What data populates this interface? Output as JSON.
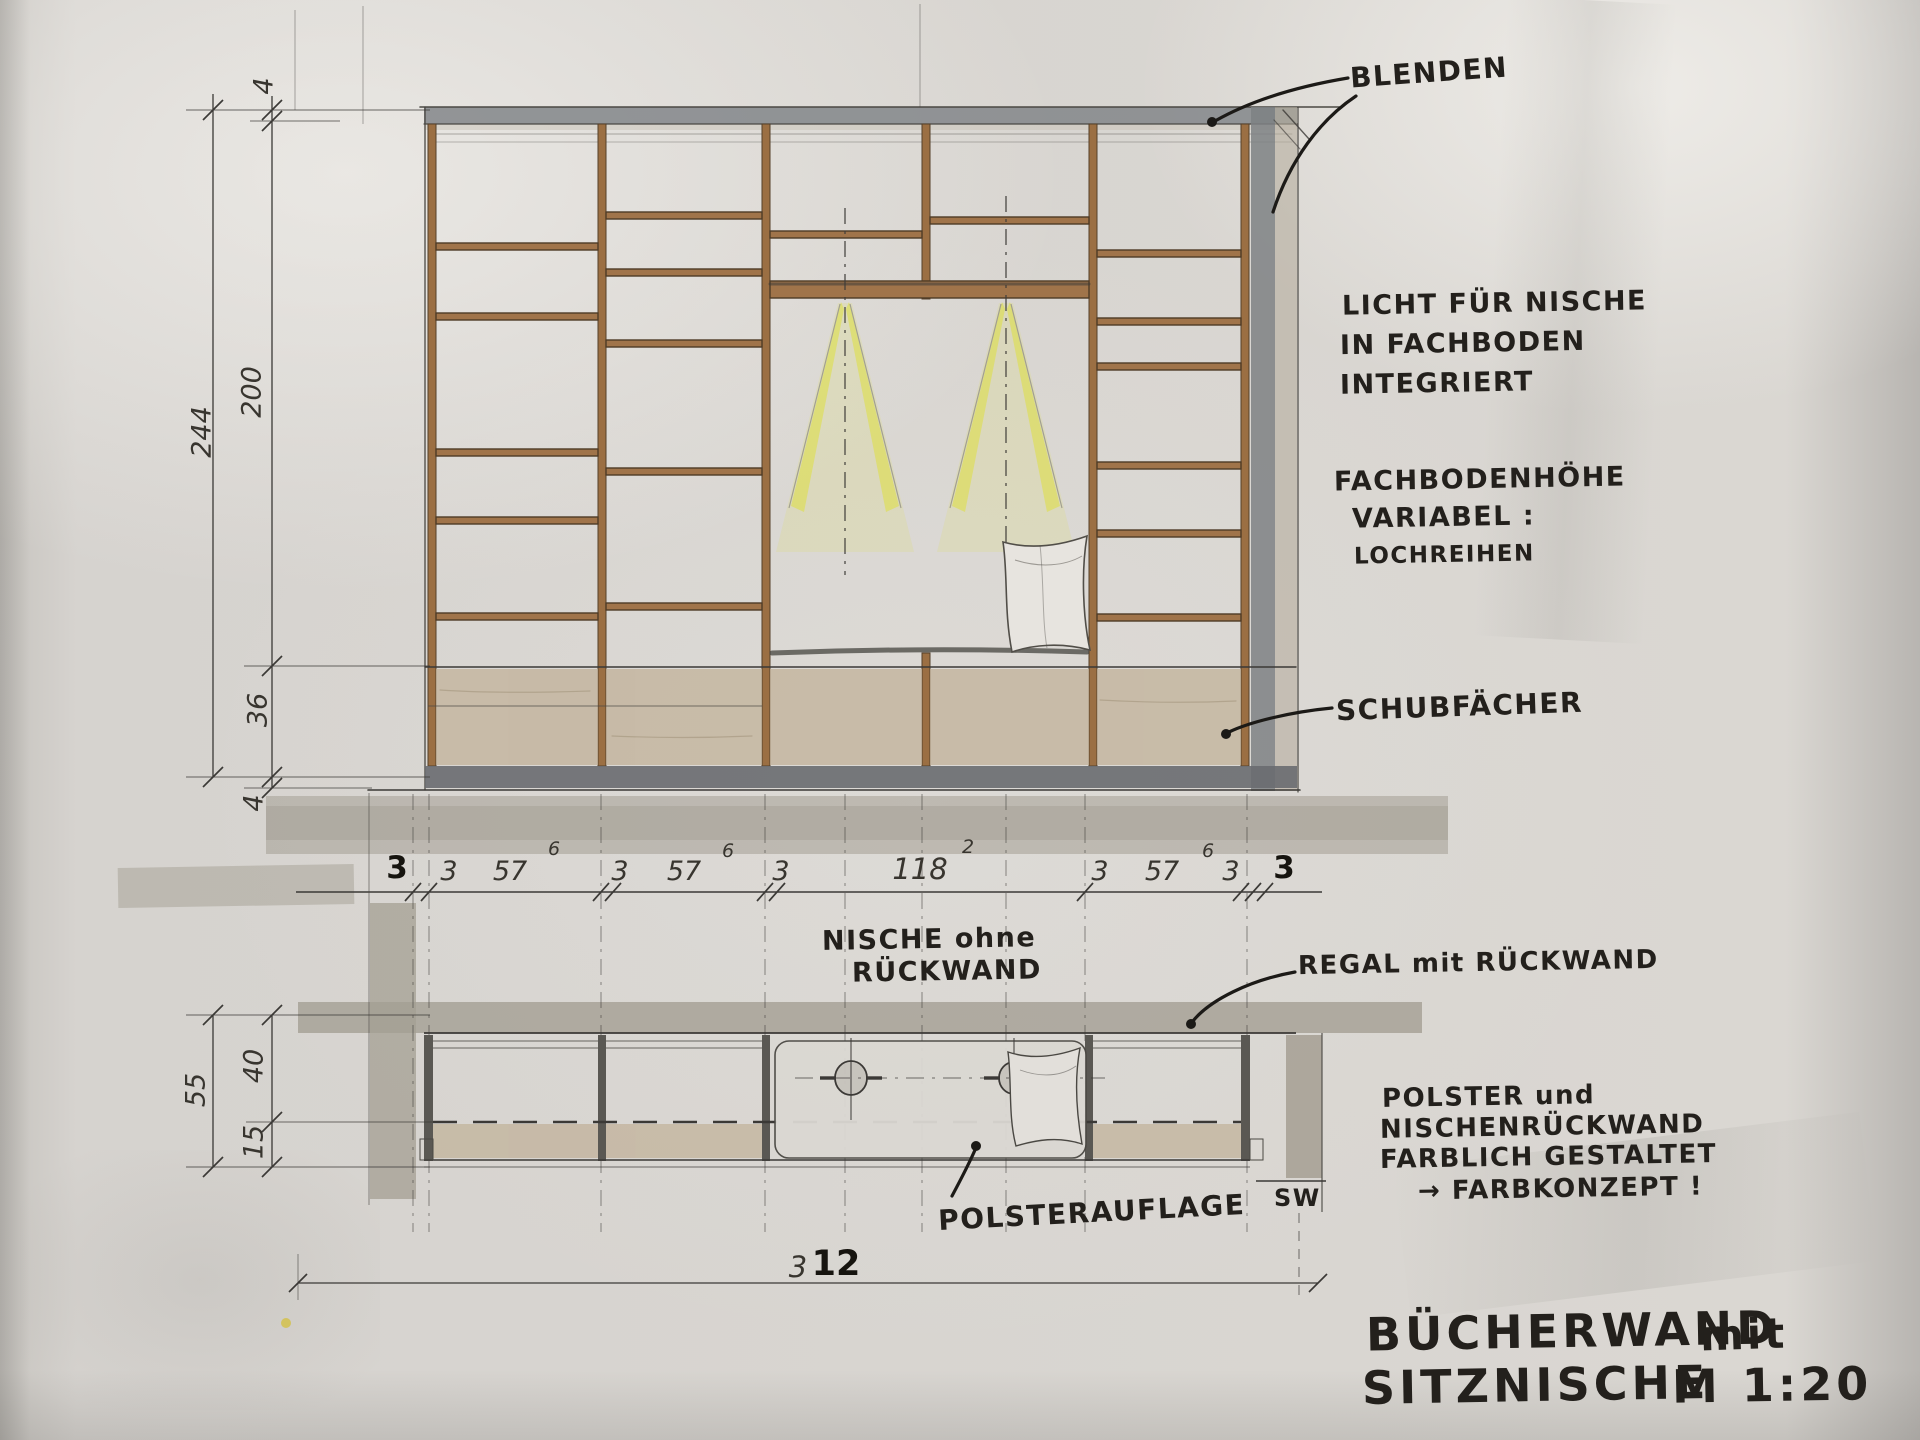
{
  "drawing": {
    "title": {
      "main1": "BÜCHERWAND",
      "main1b": "mit",
      "main2": "SITZNISCHE",
      "scale": "M 1:20"
    },
    "annotations": {
      "blenden": "BLENDEN",
      "licht_1": "LICHT FÜR NISCHE",
      "licht_2": "IN FACHBODEN",
      "licht_3": "INTEGRIERT",
      "fachboden_1": "FACHBODENHÖHE",
      "fachboden_2": "VARIABEL :",
      "fachboden_3": "LOCHREIHEN",
      "schubfaecher": "SCHUBFÄCHER",
      "nische_1": "NISCHE ohne",
      "nische_2": "RÜCKWAND",
      "regal": "REGAL mit RÜCKWAND",
      "polsterauflage": "POLSTERAUFLAGE",
      "sw": "SW",
      "polster_1": "POLSTER und",
      "polster_2": "NISCHENRÜCKWAND",
      "polster_3": "FARBLICH GESTALTET",
      "polster_4": "→ FARBKONZEPT !"
    },
    "dimensions": {
      "left_elevation": {
        "top": "4",
        "height": "200",
        "total": "244",
        "drawer": "36",
        "bottom": "4"
      },
      "chain": [
        {
          "v": "3",
          "bold": true
        },
        {
          "v": "3"
        },
        {
          "v": "57",
          "sup": "6"
        },
        {
          "v": "3"
        },
        {
          "v": "57",
          "sup": "6"
        },
        {
          "v": "3"
        },
        {
          "v": "118",
          "sup": "2"
        },
        {
          "v": "3"
        },
        {
          "v": "57",
          "sup": "6"
        },
        {
          "v": "3"
        },
        {
          "v": "3",
          "bold": true
        }
      ],
      "left_plan": {
        "total": "55",
        "depth": "40",
        "seat": "15"
      },
      "total_width": {
        "prefix": "3",
        "bold": "12"
      }
    },
    "colors": {
      "paper": "#d6d3cf",
      "pencil": "#4a4843",
      "ink": "#23201c",
      "wood": "#9b6f43",
      "grey_band": "#a49f93",
      "tan": "#c1b097",
      "plinth": "#696c70",
      "light_yellow": "#dde04a"
    }
  }
}
